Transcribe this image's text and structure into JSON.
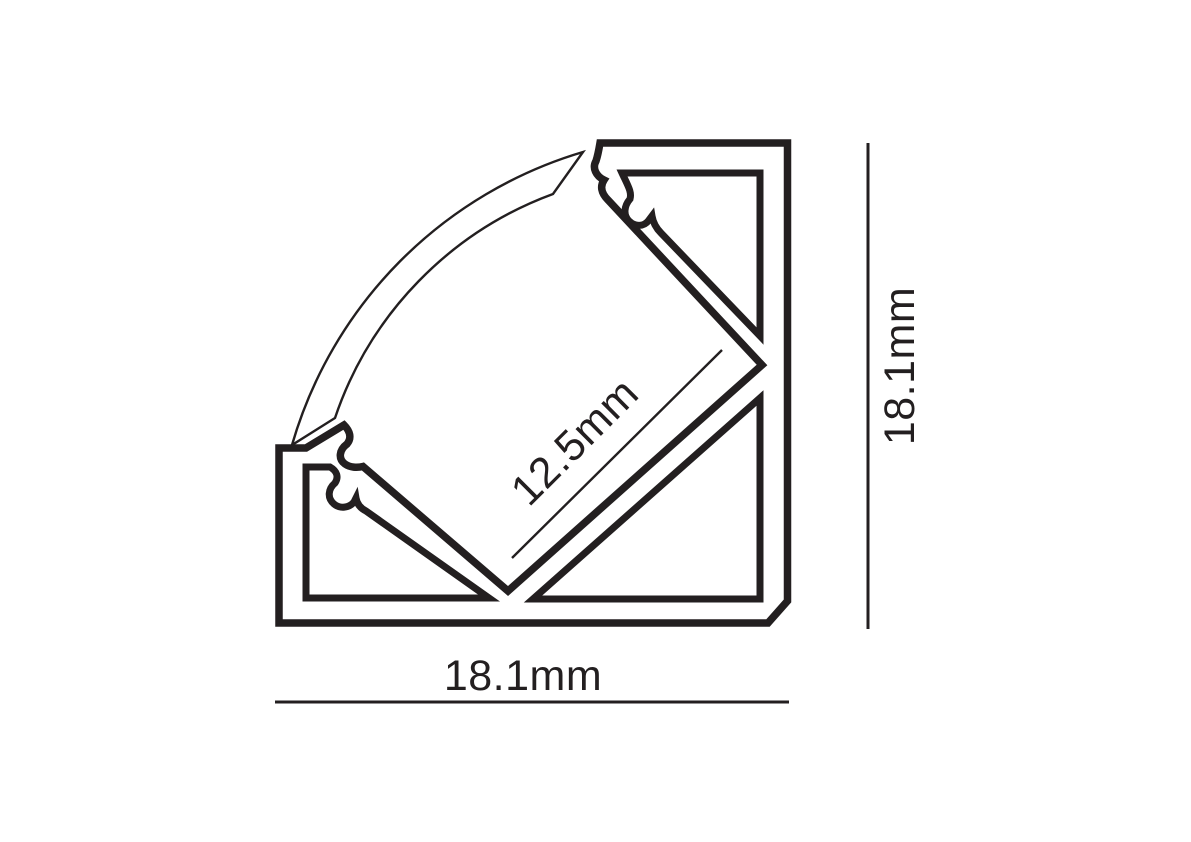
{
  "diagram": {
    "title": "corner-led-profile-cross-section",
    "line_color": "#231F20",
    "background_color": "#FFFFFF",
    "labels": {
      "channel_width": "12.5mm",
      "overall_width": "18.1mm",
      "overall_height": "18.1mm"
    }
  }
}
